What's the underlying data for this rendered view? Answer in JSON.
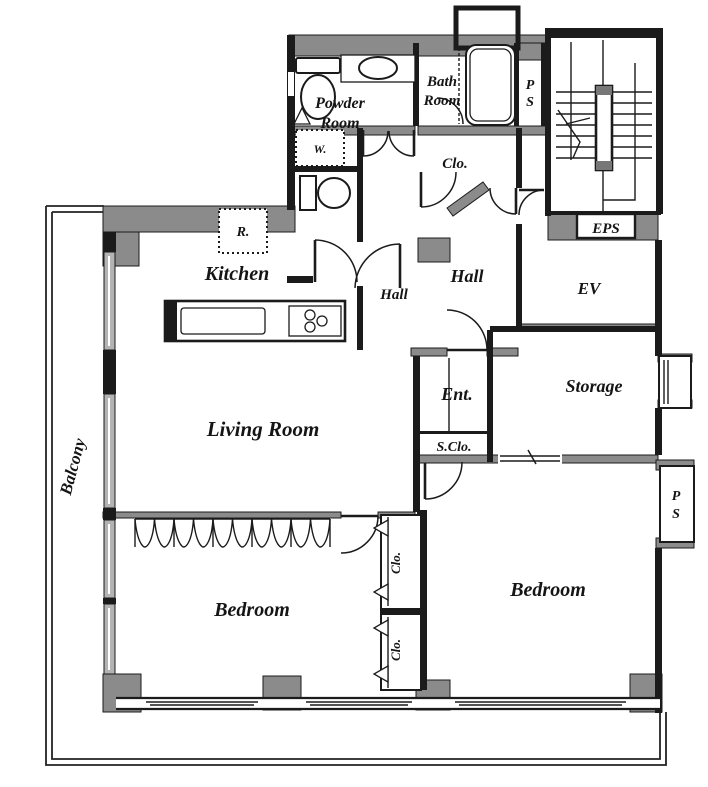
{
  "colors": {
    "wall_gray": "#8b8b8b",
    "line_black": "#1b1b1b",
    "window_gray": "#b3b3b3",
    "background": "#ffffff"
  },
  "rooms": {
    "powder_room": {
      "line1": "Powder",
      "line2": "Room"
    },
    "bath_room": {
      "line1": "Bath",
      "line2": "Room"
    },
    "ps_upper": {
      "line1": "P",
      "line2": "S"
    },
    "ps_lower": {
      "line1": "P",
      "line2": "S"
    },
    "closet_upper": "Clo.",
    "hall_main": "Hall",
    "hall_kitchen": "Hall",
    "elevator": "EV",
    "eps": "EPS",
    "storage": "Storage",
    "entrance": "Ent.",
    "shoe_closet": "S.Clo.",
    "kitchen": "Kitchen",
    "living_room": "Living Room",
    "bedroom_left": "Bedroom",
    "bedroom_right": "Bedroom",
    "closet_1": "Clo.",
    "closet_2": "Clo.",
    "balcony": "Balcony"
  },
  "fixtures": {
    "washer": "W.",
    "refrigerator": "R."
  }
}
